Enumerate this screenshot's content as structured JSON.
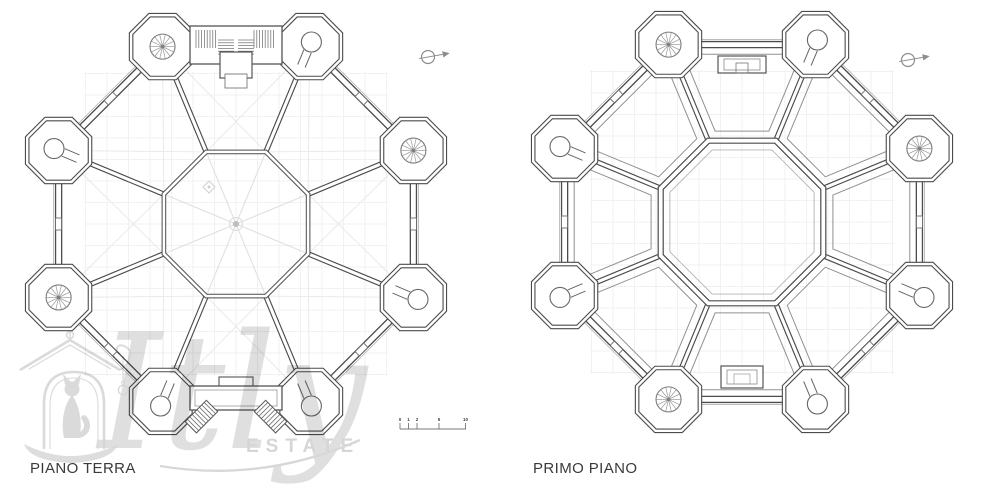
{
  "page": {
    "background": "#ffffff"
  },
  "plans": [
    {
      "id": "piano-terra",
      "label": "PIANO TERRA",
      "variant": "ground",
      "center": {
        "x": 236,
        "y": 224
      },
      "spiral_towers": [
        0,
        2,
        4
      ],
      "north_arrow": {
        "x": 428,
        "y": 57
      }
    },
    {
      "id": "primo-piano",
      "label": "PRIMO PIANO",
      "variant": "first",
      "center": {
        "x": 742,
        "y": 222
      },
      "spiral_towers": [
        0,
        2,
        5
      ],
      "north_arrow": {
        "x": 908,
        "y": 60
      }
    }
  ],
  "scale_bar": {
    "x": 400,
    "y": 429,
    "length": 66,
    "ticks": [
      0,
      8.5,
      17,
      39,
      65.5
    ],
    "labels": [
      "0",
      "1",
      "2",
      "5",
      "10"
    ]
  },
  "watermark": {
    "script": "Itly",
    "estate": "ESTATE",
    "color": "#d6d6d6"
  },
  "colors": {
    "wall": "#4b4b4b",
    "wall_mid": "#6a6a6a",
    "wall_light": "#8f8f8f",
    "faint": "#e2e2e2",
    "grid": "#f2f1ef",
    "text": "#3a3a3a"
  }
}
